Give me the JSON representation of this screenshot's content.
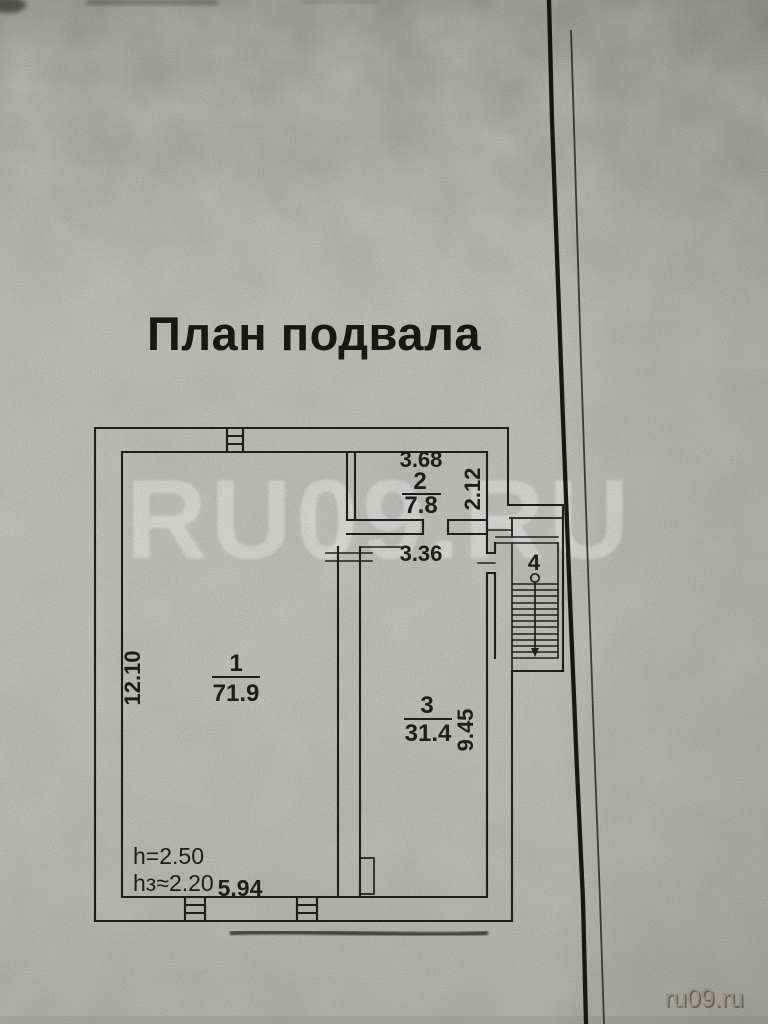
{
  "title": "План подвала",
  "watermarks": {
    "large": "RU09.RU",
    "small": "ru09.ru"
  },
  "rooms": [
    {
      "number": "1",
      "area": "71.9"
    },
    {
      "number": "2",
      "area": "7.8"
    },
    {
      "number": "3",
      "area": "31.4"
    },
    {
      "number": "4",
      "area": ""
    }
  ],
  "dimensions": {
    "room2_width_m": "3.68",
    "room2_depth_m": "2.12",
    "passage_width_m": "3.36",
    "left_side_m": "12.10",
    "room3_side_m": "9.45",
    "bottom_width_m": "5.94",
    "ceiling_height": "h=2.50",
    "basement_ceiling_height": "hз≈2.20"
  },
  "colors": {
    "paper": "#c8c8c4",
    "ink": "#242220",
    "fold_line": "#141210",
    "watermark_large": "#ffffff",
    "watermark_small": "#a99f94"
  }
}
